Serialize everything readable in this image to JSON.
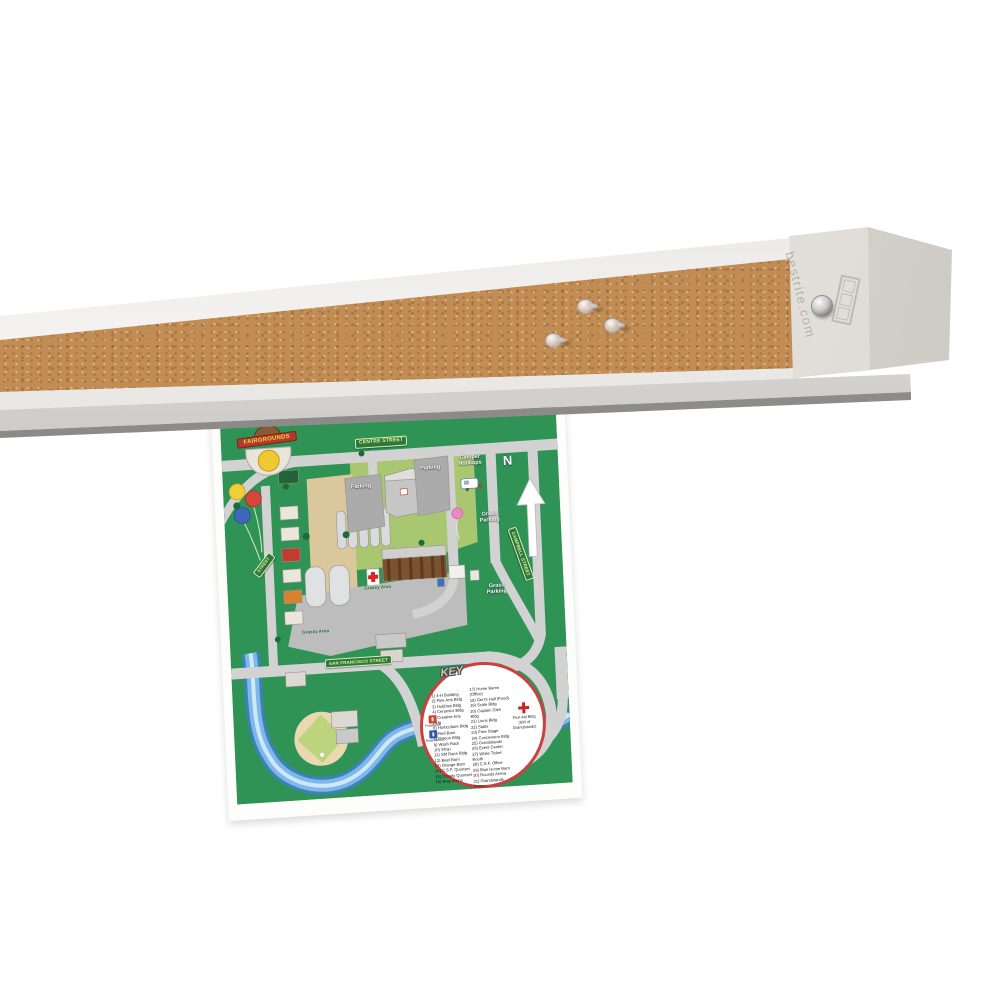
{
  "product": {
    "watermark": "bestrite.com",
    "pushpin_count": "3"
  },
  "bar_colors": {
    "cork": "#c18d55",
    "frame": "#f7f6f3",
    "rail": "#b9b7b3"
  },
  "map": {
    "logo_text": "FAIRGROUNDS",
    "north_label": "N",
    "signs": {
      "centre": "CENTRE STREET",
      "san_francisco": "SAN FRANCISCO STREET",
      "campbell": "CAMPBELL STREET",
      "west": "STREET"
    },
    "labels": {
      "parking_west": "Parking",
      "parking_east": "Parking",
      "camper_hookups": "Camper Hookups",
      "grass_parking_north": "Grass Parking",
      "grass_parking_south": "Grass Parking",
      "grassy_area_north": "Grassy Area",
      "grassy_area_south": "Grassy Area"
    },
    "map_colors": {
      "green": "#2e9355",
      "road": "#d2d2d2",
      "river": "#7db8e8",
      "sign_green": "#2a7a3b"
    },
    "key": {
      "title": "KEY",
      "column1": [
        "1) 4-H Building",
        "2) Fine Arts Bldg",
        "3) Hobbies Bldg",
        "4) Ceramics Bldg",
        "5) Creative Arts Bldg",
        "6) Horticulture Bldg",
        "7) Red Barn",
        "8) Pigeon Bldg",
        "9) Wash Rack",
        "10) Shop",
        "11) SM Race Bldg",
        "12) Beef Barn",
        "13) Orange Barn",
        "14) C.S.F. Quonset",
        "15) County Quonset",
        "16) Bray Arena"
      ],
      "column2": [
        "17) Horse Barns (Office)",
        "18) Gert's Hall (Food)",
        "19) Scale Bldg",
        "20) Captain Glen Bldg",
        "21) Lions Bldg",
        "22) Stalls",
        "23) Free Stage",
        "24) Concession Bldg",
        "25) Grandstands",
        "26) Event Center",
        "27) White Ticket Booth",
        "28) C.S.F. Office",
        "29) Blue Horse Barn",
        "30) Rounds Arena",
        "31) Grandstands Arena",
        "32) Stalling Office"
      ],
      "food_drink_label": "Food/Drink",
      "restrooms_label": "Restrooms",
      "first_aid_label": "First Aid Bldg (SW of Grandstands)"
    }
  }
}
